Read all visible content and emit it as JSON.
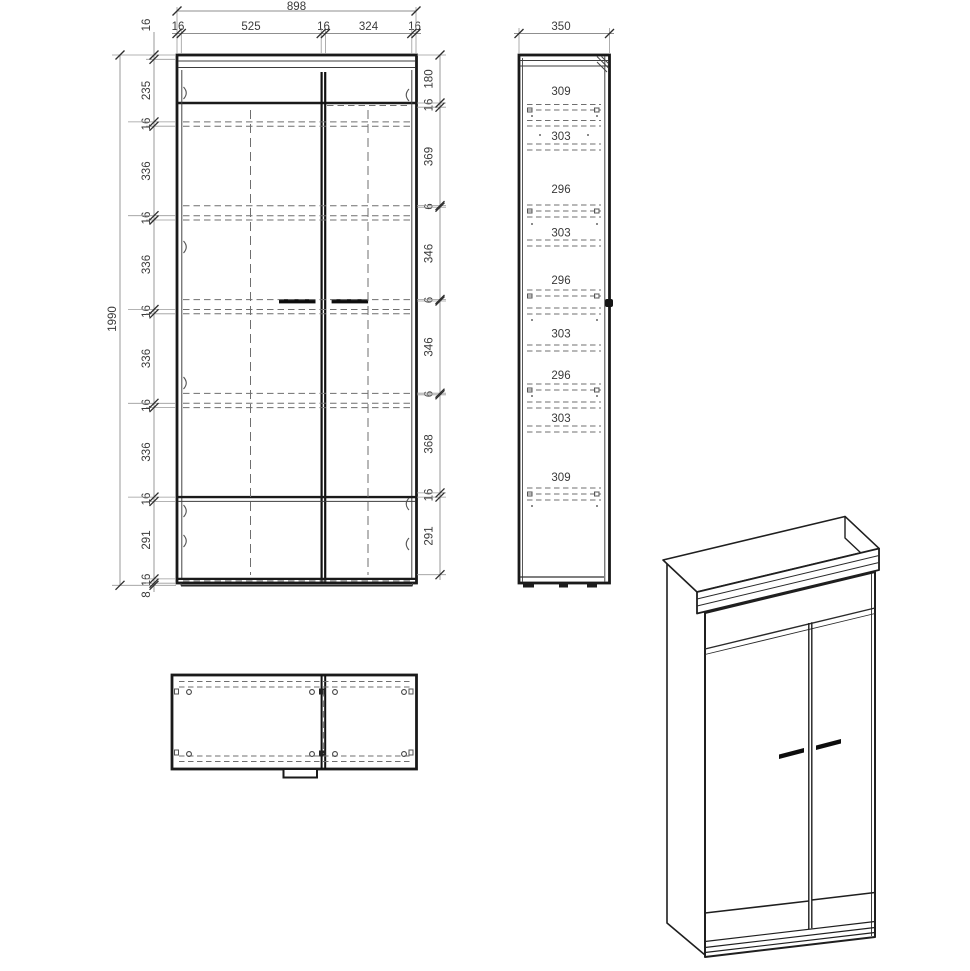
{
  "drawing_title": "wardrobe-technical-drawing",
  "front_view": {
    "width_total": "898",
    "top_segments": [
      "16",
      "525",
      "16",
      "324",
      "16"
    ],
    "height_total": "1990",
    "left_segments": [
      "16",
      "235",
      "16",
      "336",
      "16",
      "336",
      "16",
      "336",
      "16",
      "336",
      "16",
      "291",
      "16"
    ],
    "plinth": "8",
    "right_segments": [
      "180",
      "16",
      "369",
      "6",
      "346",
      "6",
      "346",
      "6",
      "368",
      "16",
      "291"
    ]
  },
  "side_view": {
    "depth_total": "350",
    "gap_labels": [
      "309",
      "303",
      "296",
      "303",
      "296",
      "303",
      "296",
      "303",
      "309"
    ]
  },
  "colors": {
    "line": "#1a1a1a",
    "dimension_text": "#3a3a3a",
    "hidden_line": "#6f6f6f",
    "background": "#ffffff"
  }
}
